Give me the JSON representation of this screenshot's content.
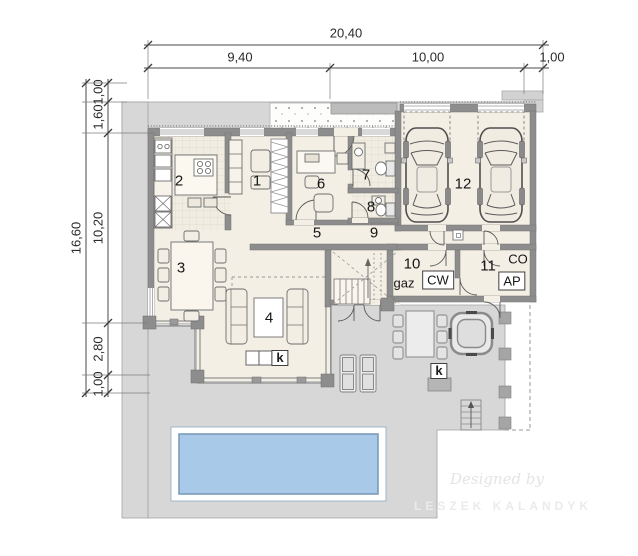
{
  "dimensions": {
    "top": {
      "total": "20,40",
      "s1": "9,40",
      "s2": "10,00",
      "s3": "1,00"
    },
    "left": {
      "total": "16,60",
      "s1": "1,00",
      "s2": "1,60",
      "s3": "10,20",
      "s4": "2,80",
      "s5": "1,00"
    }
  },
  "rooms": {
    "r1": "1",
    "r2": "2",
    "r3": "3",
    "r4": "4",
    "r5": "5",
    "r6": "6",
    "r7": "7",
    "r8": "8",
    "r9": "9",
    "r10": "10",
    "r11": "11",
    "r12": "12"
  },
  "labels": {
    "gas": "gaz",
    "cw": "CW",
    "ap": "AP",
    "co": "CO",
    "fireplace_k": "k",
    "grill_k": "k"
  },
  "watermark": {
    "script": "Designed by",
    "name": "LESZEK KALANDYK"
  },
  "colors": {
    "terrace": "#d7d7d7",
    "floor": "#f4efe5",
    "wall": "#8d8d8d",
    "pool_water": "#a9c9e8"
  }
}
